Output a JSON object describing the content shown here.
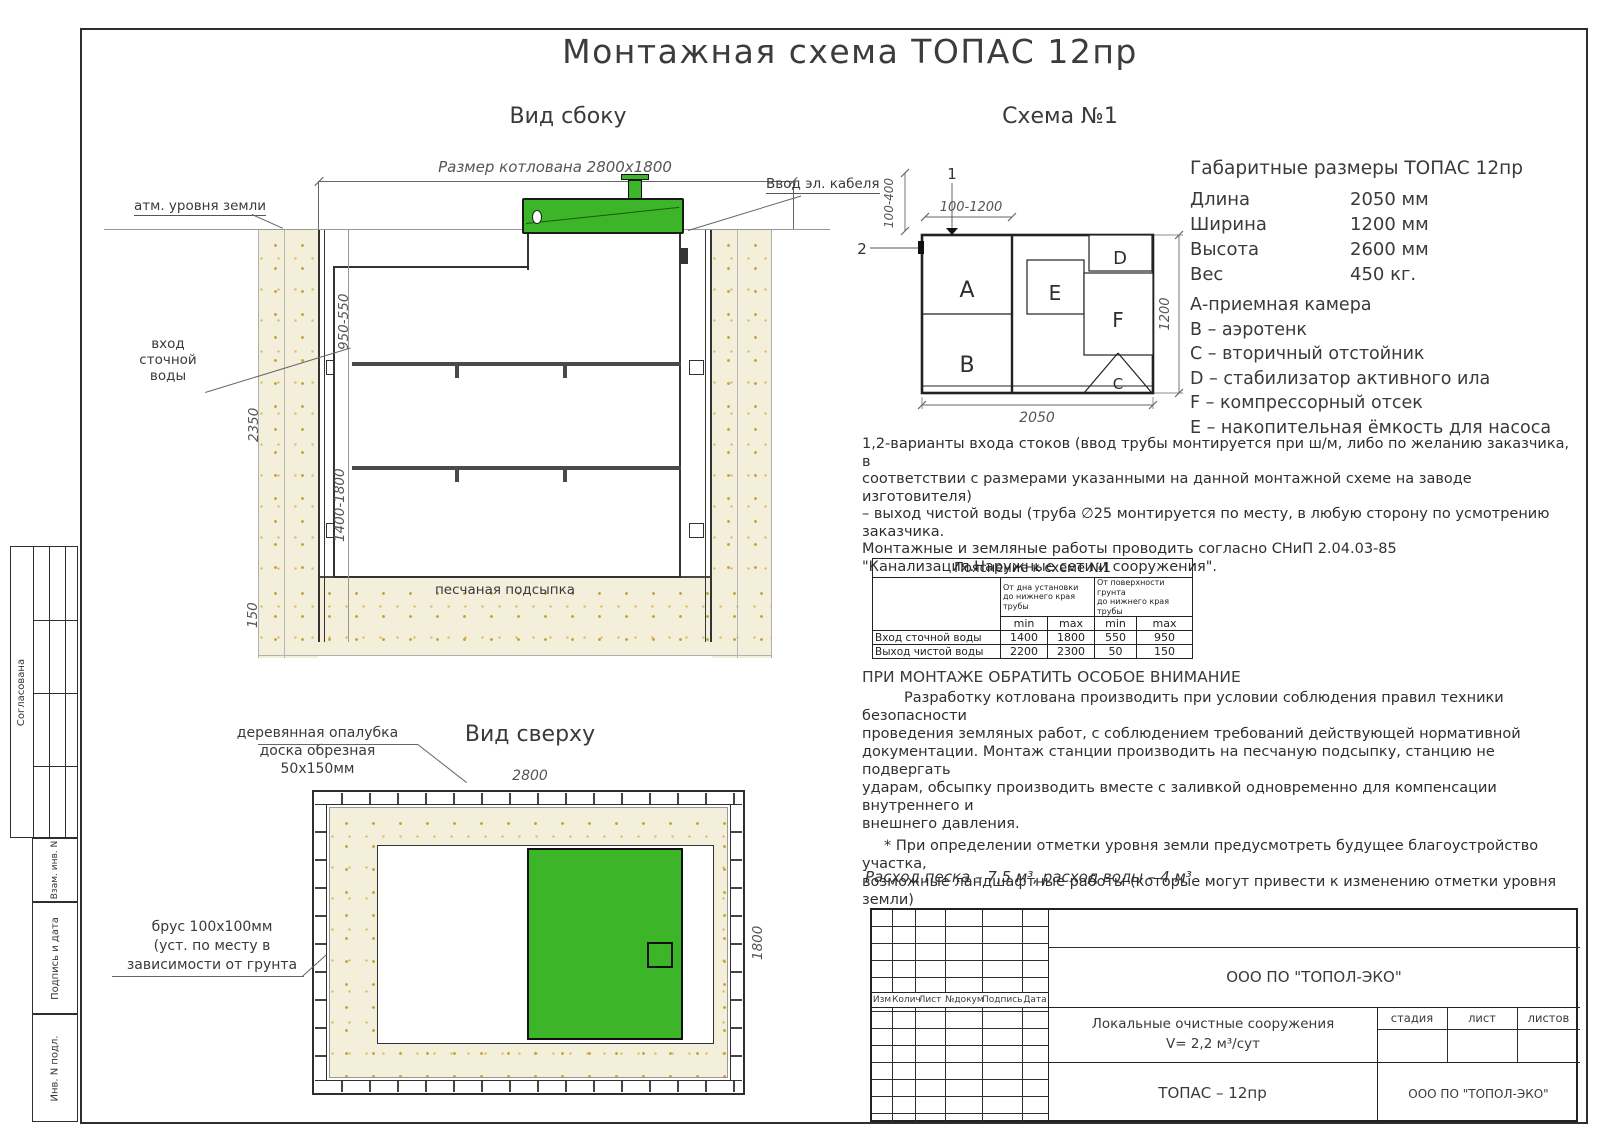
{
  "title": "Монтажная схема ТОПАС 12пр",
  "side_view": {
    "heading": "Вид сбоку",
    "pit_dimension": "Размер котлована 2800х1800",
    "ground_label": "атм. уровня земли",
    "cable_label": "Ввод эл. кабеля",
    "inlet_label": "вход\nсточной\nводы",
    "sand_label": "песчаная подсыпка",
    "dim_depth_upper": "950-550",
    "dim_total_depth": "2350",
    "dim_inlet_range": "1400-1800",
    "dim_bedding": "150"
  },
  "scheme": {
    "heading": "Схема №1",
    "marker_1": "1",
    "marker_2": "2",
    "dim_top": "100-1200",
    "dim_left": "100-400",
    "dim_right": "1200",
    "dim_bottom": "2050",
    "comp_a": "A",
    "comp_b": "B",
    "comp_c": "C",
    "comp_d": "D",
    "comp_e": "E",
    "comp_f": "F"
  },
  "specs": {
    "heading": "Габаритные размеры ТОПАС 12пр",
    "rows": [
      {
        "label": "Длина",
        "value": "2050 мм"
      },
      {
        "label": "Ширина",
        "value": "1200 мм"
      },
      {
        "label": "Высота",
        "value": "2600 мм"
      },
      {
        "label": "Вес",
        "value": "450 кг."
      }
    ]
  },
  "legend": [
    "А-приемная камера",
    "В – аэротенк",
    "С – вторичный отстойник",
    "D – стабилизатор активного ила",
    "F – компрессорный отсек",
    "Е – накопительная ёмкость для насоса"
  ],
  "notes": "1,2-варианты входа  стоков (ввод трубы монтируется при ш/м, либо по желанию заказчика, в\nсоответствии с размерами указанными на данной монтажной схеме на заводе изготовителя)\n– выход чистой воды (труба ∅25 монтируется по месту, в любую сторону по усмотрению\nзаказчика.\nМонтажные и земляные работы проводить согласно СНиП 2.04.03-85\n\"Канализация.Наружные сети и сооружения\".",
  "pipe_table": {
    "caption": "Пояснение к схеме №1",
    "group_1": "От дна установки\nдо нижнего края трубы",
    "group_2": "От поверхности грунта\nдо нижнего края трубы",
    "min_label": "min",
    "max_label": "max",
    "rows": [
      {
        "label": "Вход сточной воды",
        "v1": "1400",
        "v2": "1800",
        "v3": "550",
        "v4": "950"
      },
      {
        "label": "Выход чистой воды",
        "v1": "2200",
        "v2": "2300",
        "v3": "50",
        "v4": "150"
      }
    ]
  },
  "attention": {
    "heading": "ПРИ МОНТАЖЕ ОБРАТИТЬ ОСОБОЕ ВНИМАНИЕ",
    "body": "Разработку котлована производить при условии соблюдения правил техники безопасности\nпроведения земляных работ, с соблюдением требований действующей нормативной\nдокументации. Монтаж станции производить на песчаную подсыпку, станцию не подвергать\nударам, обсыпку производить вместе с заливкой одновременно для компенсации внутреннего и\nвнешнего давления.",
    "note": "* При определении отметки уровня земли предусмотреть будущее благоустройство участка,\nвозможные ландшафтные работы (которые могут привести к изменению отметки уровня земли)"
  },
  "consumption": "Расход песка – 7,5 м³, расход воды – 4 м³",
  "top_view": {
    "heading": "Вид сверху",
    "formwork_label": "деревянная опалубка\nдоска обрезная\n50х150мм",
    "timber_label": "брус 100х100мм\n(уст. по месту в\nзависимости от грунта",
    "dim_top": "2800",
    "dim_right": "1800"
  },
  "titleblock": {
    "cols": [
      "Изм",
      "Колич",
      "Лист",
      "№докум",
      "Подпись",
      "Дата"
    ],
    "company": "ООО ПО \"ТОПОЛ-ЭКО\"",
    "project": "Локальные очистные сооружения",
    "volume": "V= 2,2 м³/сут",
    "stage_label": "стадия",
    "sheet_label": "лист",
    "sheets_label": "листов",
    "product": "ТОПАС – 12пр",
    "company_2": "ООО ПО \"ТОПОЛ-ЭКО\""
  },
  "sidebar": {
    "approved": "Согласована",
    "row_1": "Взам. инв. N",
    "row_2": "Подпись и дата",
    "row_3": "Инв. N подл."
  },
  "colors": {
    "green": "#3cb528",
    "sand": "#f4efdb",
    "sand_dot": "#c9a53f",
    "line": "#2e2e2e"
  }
}
